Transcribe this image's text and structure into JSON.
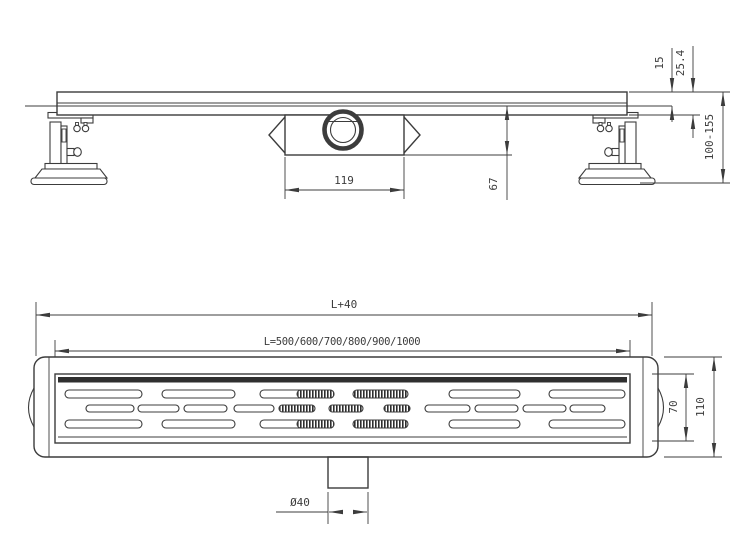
{
  "colors": {
    "line": "#3c3c3c",
    "hatch": "#2e2e2e",
    "band": "#2f2f2f",
    "background": "#ffffff"
  },
  "side_view": {
    "dims": {
      "grate_thickness": "15",
      "channel_height": "25.4",
      "adjustable_height": "100-155",
      "trap_body_width": "119",
      "trap_depth": "67"
    }
  },
  "plan_view": {
    "dims": {
      "overall_length": "L+40",
      "channel_lengths": "L=500/600/700/800/900/1000",
      "grate_width": "70",
      "body_width": "110",
      "outlet_diameter": "Ø40"
    },
    "grate_rows": [
      {
        "y": 390,
        "h": 8,
        "slots": [
          {
            "x": 65,
            "w": 77,
            "hatch": "none"
          },
          {
            "x": 162,
            "w": 73,
            "hatch": "none"
          },
          {
            "x": 260,
            "w": 74,
            "hatch": "right"
          },
          {
            "x": 353,
            "w": 55,
            "hatch": "full"
          },
          {
            "x": 449,
            "w": 71,
            "hatch": "none"
          },
          {
            "x": 549,
            "w": 76,
            "hatch": "none"
          }
        ]
      },
      {
        "y": 405,
        "h": 7,
        "slots": [
          {
            "x": 86,
            "w": 48,
            "hatch": "none"
          },
          {
            "x": 138,
            "w": 41,
            "hatch": "none"
          },
          {
            "x": 184,
            "w": 43,
            "hatch": "none"
          },
          {
            "x": 234,
            "w": 40,
            "hatch": "none"
          },
          {
            "x": 279,
            "w": 36,
            "hatch": "full"
          },
          {
            "x": 329,
            "w": 34,
            "hatch": "full"
          },
          {
            "x": 384,
            "w": 26,
            "hatch": "full"
          },
          {
            "x": 425,
            "w": 45,
            "hatch": "none"
          },
          {
            "x": 475,
            "w": 43,
            "hatch": "none"
          },
          {
            "x": 523,
            "w": 43,
            "hatch": "none"
          },
          {
            "x": 570,
            "w": 35,
            "hatch": "none"
          }
        ]
      },
      {
        "y": 420,
        "h": 8,
        "slots": [
          {
            "x": 65,
            "w": 77,
            "hatch": "none"
          },
          {
            "x": 162,
            "w": 73,
            "hatch": "none"
          },
          {
            "x": 260,
            "w": 74,
            "hatch": "right"
          },
          {
            "x": 353,
            "w": 55,
            "hatch": "full"
          },
          {
            "x": 449,
            "w": 71,
            "hatch": "none"
          },
          {
            "x": 549,
            "w": 76,
            "hatch": "none"
          }
        ]
      }
    ]
  }
}
